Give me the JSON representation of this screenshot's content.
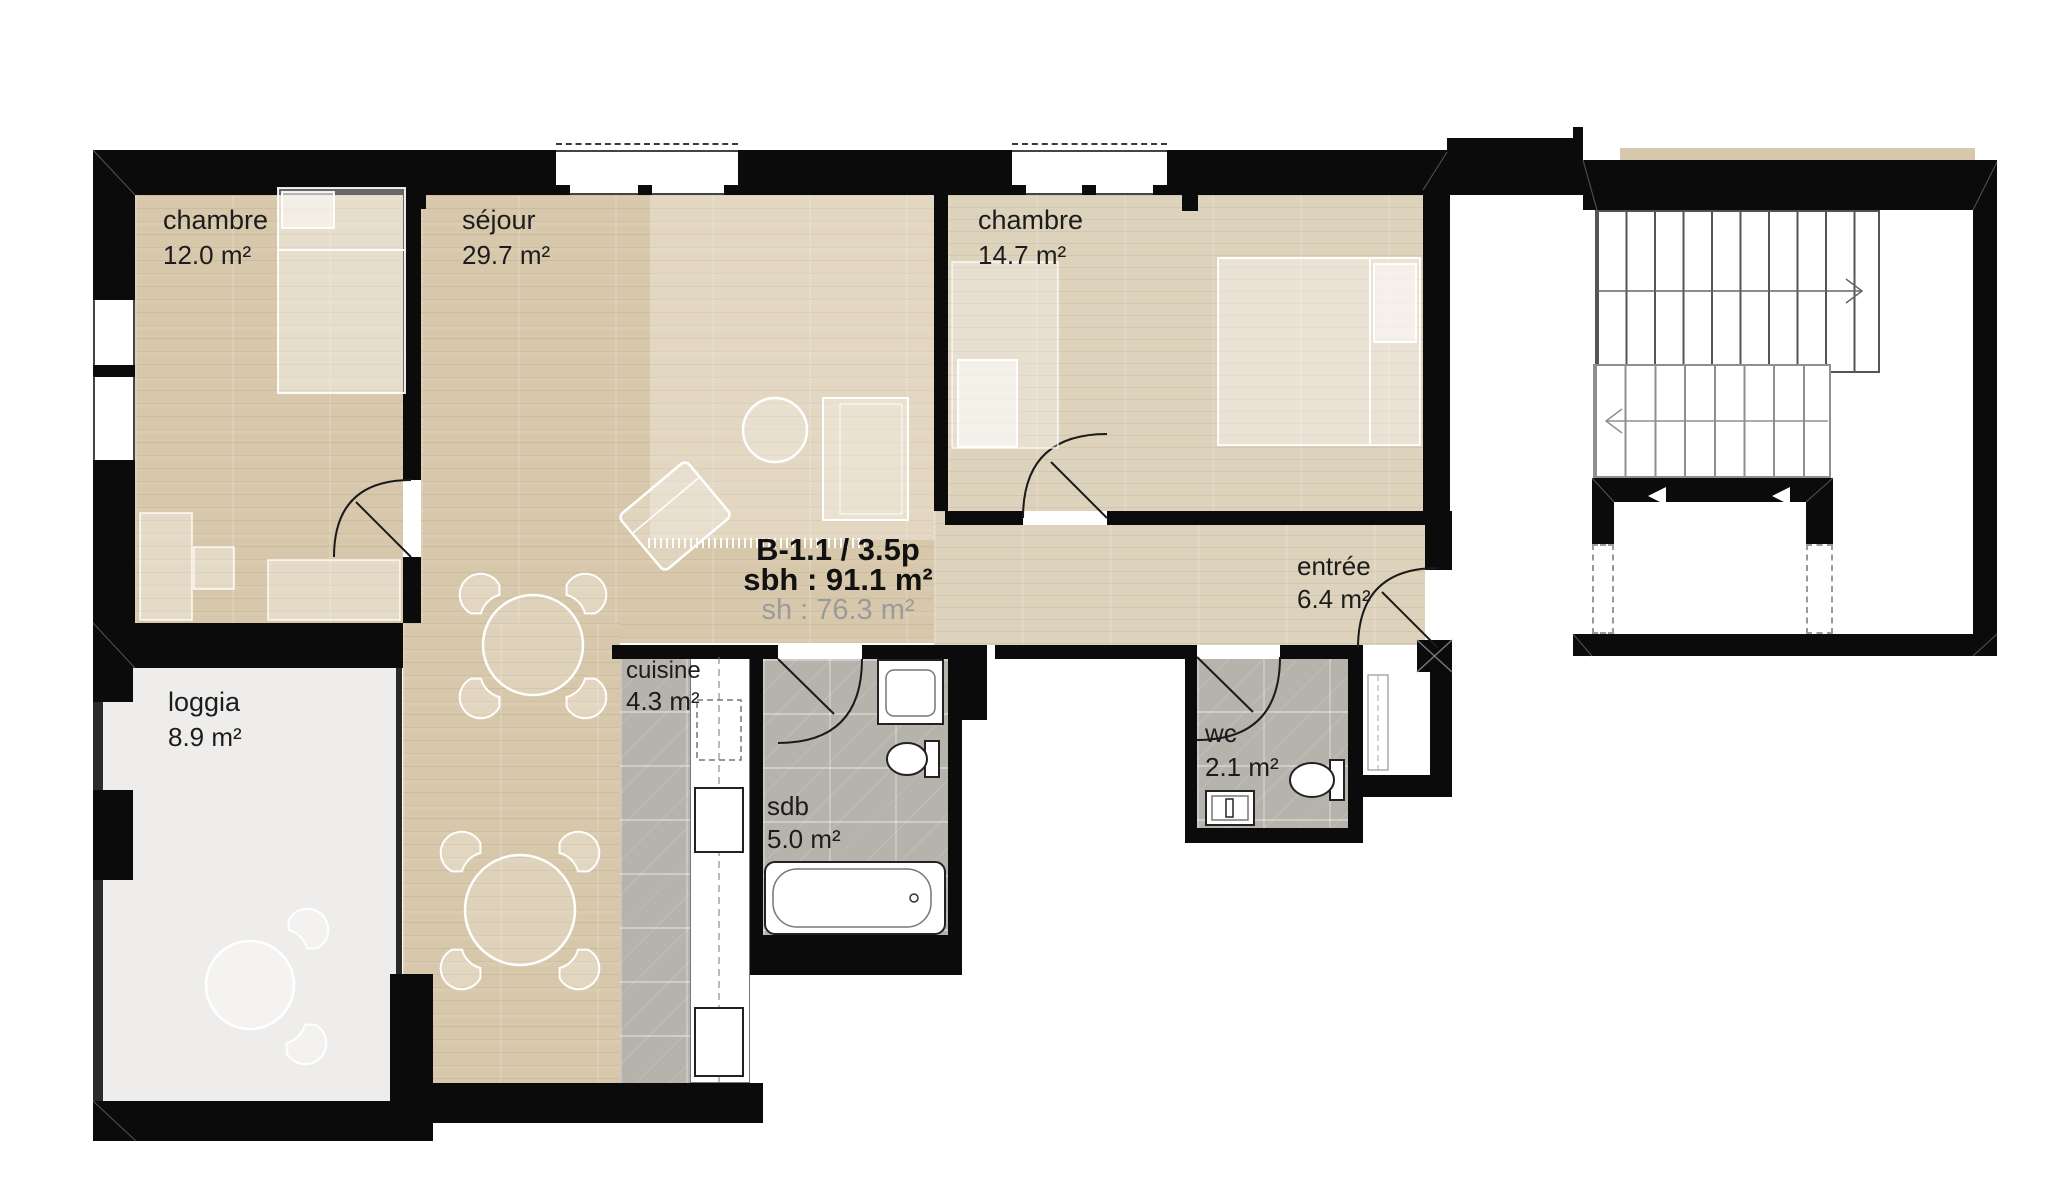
{
  "unit": {
    "title": "B-1.1 / 3.5p",
    "sbh": "sbh : 91.1 m²",
    "sh": "sh : 76.3 m²"
  },
  "rooms": [
    {
      "name": "chambre-1",
      "label": "chambre",
      "area": "12.0 m²"
    },
    {
      "name": "sejour",
      "label": "séjour",
      "area": "29.7 m²"
    },
    {
      "name": "chambre-2",
      "label": "chambre",
      "area": "14.7 m²"
    },
    {
      "name": "entree",
      "label": "entrée",
      "area": "6.4 m²"
    },
    {
      "name": "loggia",
      "label": "loggia",
      "area": "8.9 m²"
    },
    {
      "name": "cuisine",
      "label": "cuisine",
      "area": "4.3 m²"
    },
    {
      "name": "sdb",
      "label": "sdb",
      "area": "5.0 m²"
    },
    {
      "name": "wc",
      "label": "wc",
      "area": "2.1 m²"
    }
  ],
  "stairs": {
    "upper_flight_steps": 10,
    "lower_flight_steps": 8,
    "upper_arrow": "right",
    "lower_arrow": "left"
  },
  "colors": {
    "wall": "#0b0b0b",
    "wood": "#d8c8ab",
    "wood_light": "#ddd2bb",
    "tile": "#b6b2ac",
    "loggia_floor": "#eeedeb"
  }
}
